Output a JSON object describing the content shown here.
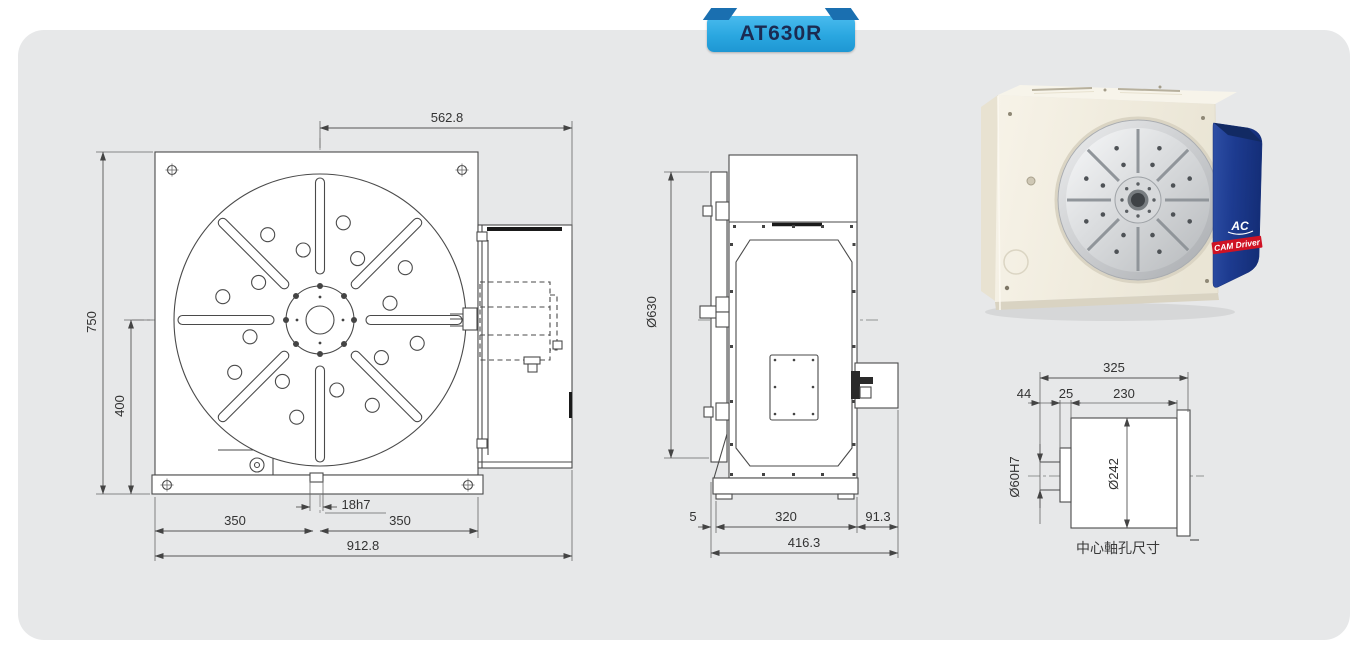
{
  "title_badge": {
    "label": "AT630R"
  },
  "front_view": {
    "dim_top_width": "562.8",
    "dim_height": "750",
    "dim_center_height": "400",
    "dim_left_half": "350",
    "dim_keyway": "18h7",
    "dim_right_half": "350",
    "dim_overall_width": "912.8"
  },
  "side_view": {
    "dim_table_diameter": "Ø630",
    "dim_face_protrusion": "5",
    "dim_body_width": "320",
    "dim_motor_box": "91.3",
    "dim_overall_depth": "416.3"
  },
  "bore_detail": {
    "caption": "中心軸孔尺寸",
    "dim_overall_length": "325",
    "dim_shaft_protrusion": "44",
    "dim_step": "25",
    "dim_body_length": "230",
    "dim_bore": "Ø60H7",
    "dim_hub_diameter": "Ø242"
  },
  "product_photo": {
    "logo_text": "AC",
    "band_text": "CAM Driver"
  },
  "colors": {
    "badge_blue": "#2AA7E0",
    "badge_fold": "#1A6FB0",
    "badge_text": "#1B2B52",
    "panel_gray": "#E7E8E9",
    "drawing_line": "#4A4A4A",
    "photo_body_cream": "#F2EEE1",
    "photo_cover_blue": "#1D3B90",
    "photo_band_red": "#CF1224"
  }
}
